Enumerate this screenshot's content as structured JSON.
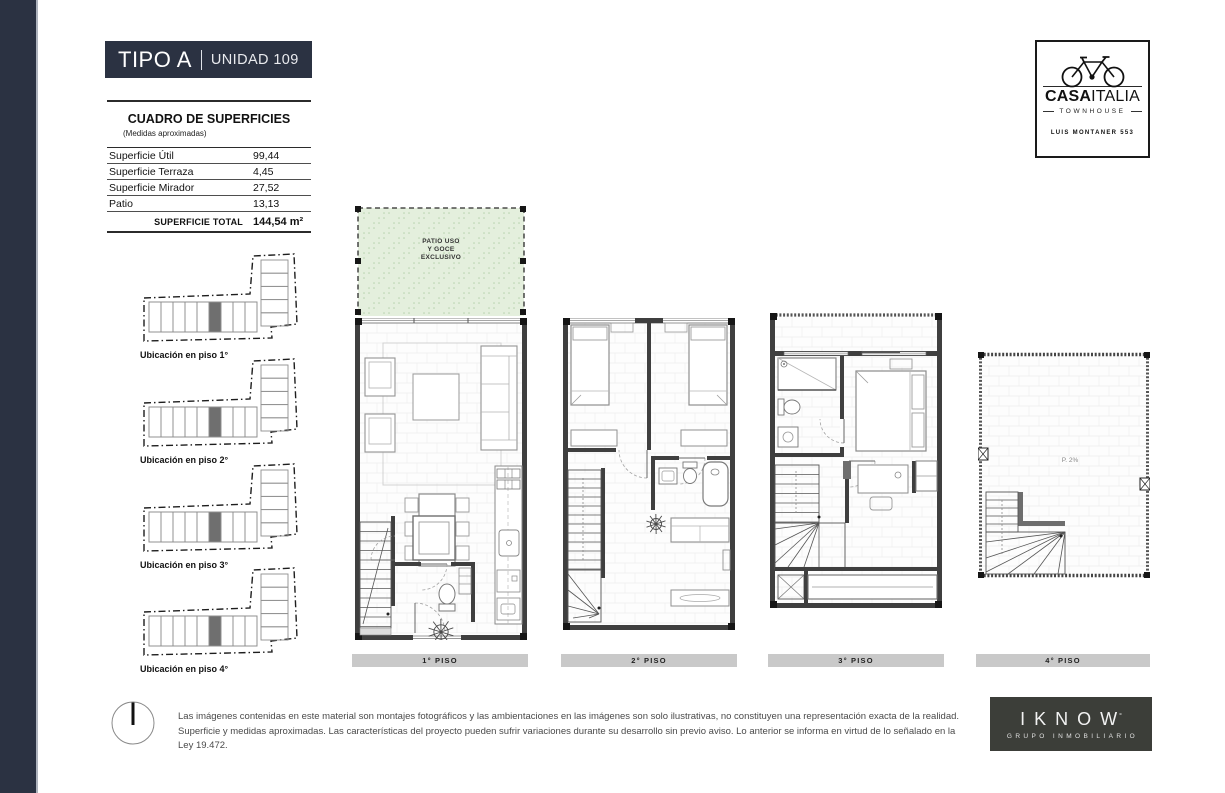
{
  "title": {
    "type": "TIPO A",
    "separator": "|",
    "unit": "UNIDAD 109"
  },
  "brand": {
    "name_bold": "CASA",
    "name_light": "ITALIA",
    "subtitle": "TOWNHOUSE",
    "address": "LUIS MONTANER 553"
  },
  "surface_table": {
    "title": "CUADRO DE SUPERFICIES",
    "subtitle": "(Medidas aproximadas)",
    "rows": [
      {
        "label": "Superficie Útil",
        "value": "99,44"
      },
      {
        "label": "Superficie Terraza",
        "value": "4,45"
      },
      {
        "label": "Superficie Mirador",
        "value": "27,52"
      },
      {
        "label": "Patio",
        "value": "13,13"
      }
    ],
    "total": {
      "label": "SUPERFICIE TOTAL",
      "value": "144,54 m²"
    }
  },
  "location_diagrams": [
    {
      "label": "Ubicación en piso 1°"
    },
    {
      "label": "Ubicación en piso 2°"
    },
    {
      "label": "Ubicación en piso 3°"
    },
    {
      "label": "Ubicación en piso 4°"
    }
  ],
  "floor_plans": [
    {
      "label": "1° PISO",
      "patio_lines": [
        "PATIO USO",
        "Y GOCE",
        "EXCLUSIVO"
      ]
    },
    {
      "label": "2° PISO"
    },
    {
      "label": "3° PISO"
    },
    {
      "label": "4° PISO",
      "annotation": "P. 2%"
    }
  ],
  "footer": {
    "disclaimer": "Las imágenes contenidas en este material son montajes fotográficos y las ambientaciones en las imágenes son solo ilustrativas, no constituyen una representación exacta de la realidad. Superficie y medidas aproximadas. Las características del proyecto pueden sufrir variaciones durante su desarrollo sin previo aviso. Lo anterior se informa en virtud de lo señalado en la Ley 19.472."
  },
  "developer": {
    "name": "IKNOW",
    "mark": "°",
    "subtitle": "GRUPO INMOBILIARIO"
  },
  "colors": {
    "navy": "#2b3242",
    "patio_green": "#e4efdd",
    "floor_bar_gray": "#c9c9c9",
    "developer_bg": "#3c3e39",
    "highlight_unit_gray": "#6f6f6f"
  }
}
